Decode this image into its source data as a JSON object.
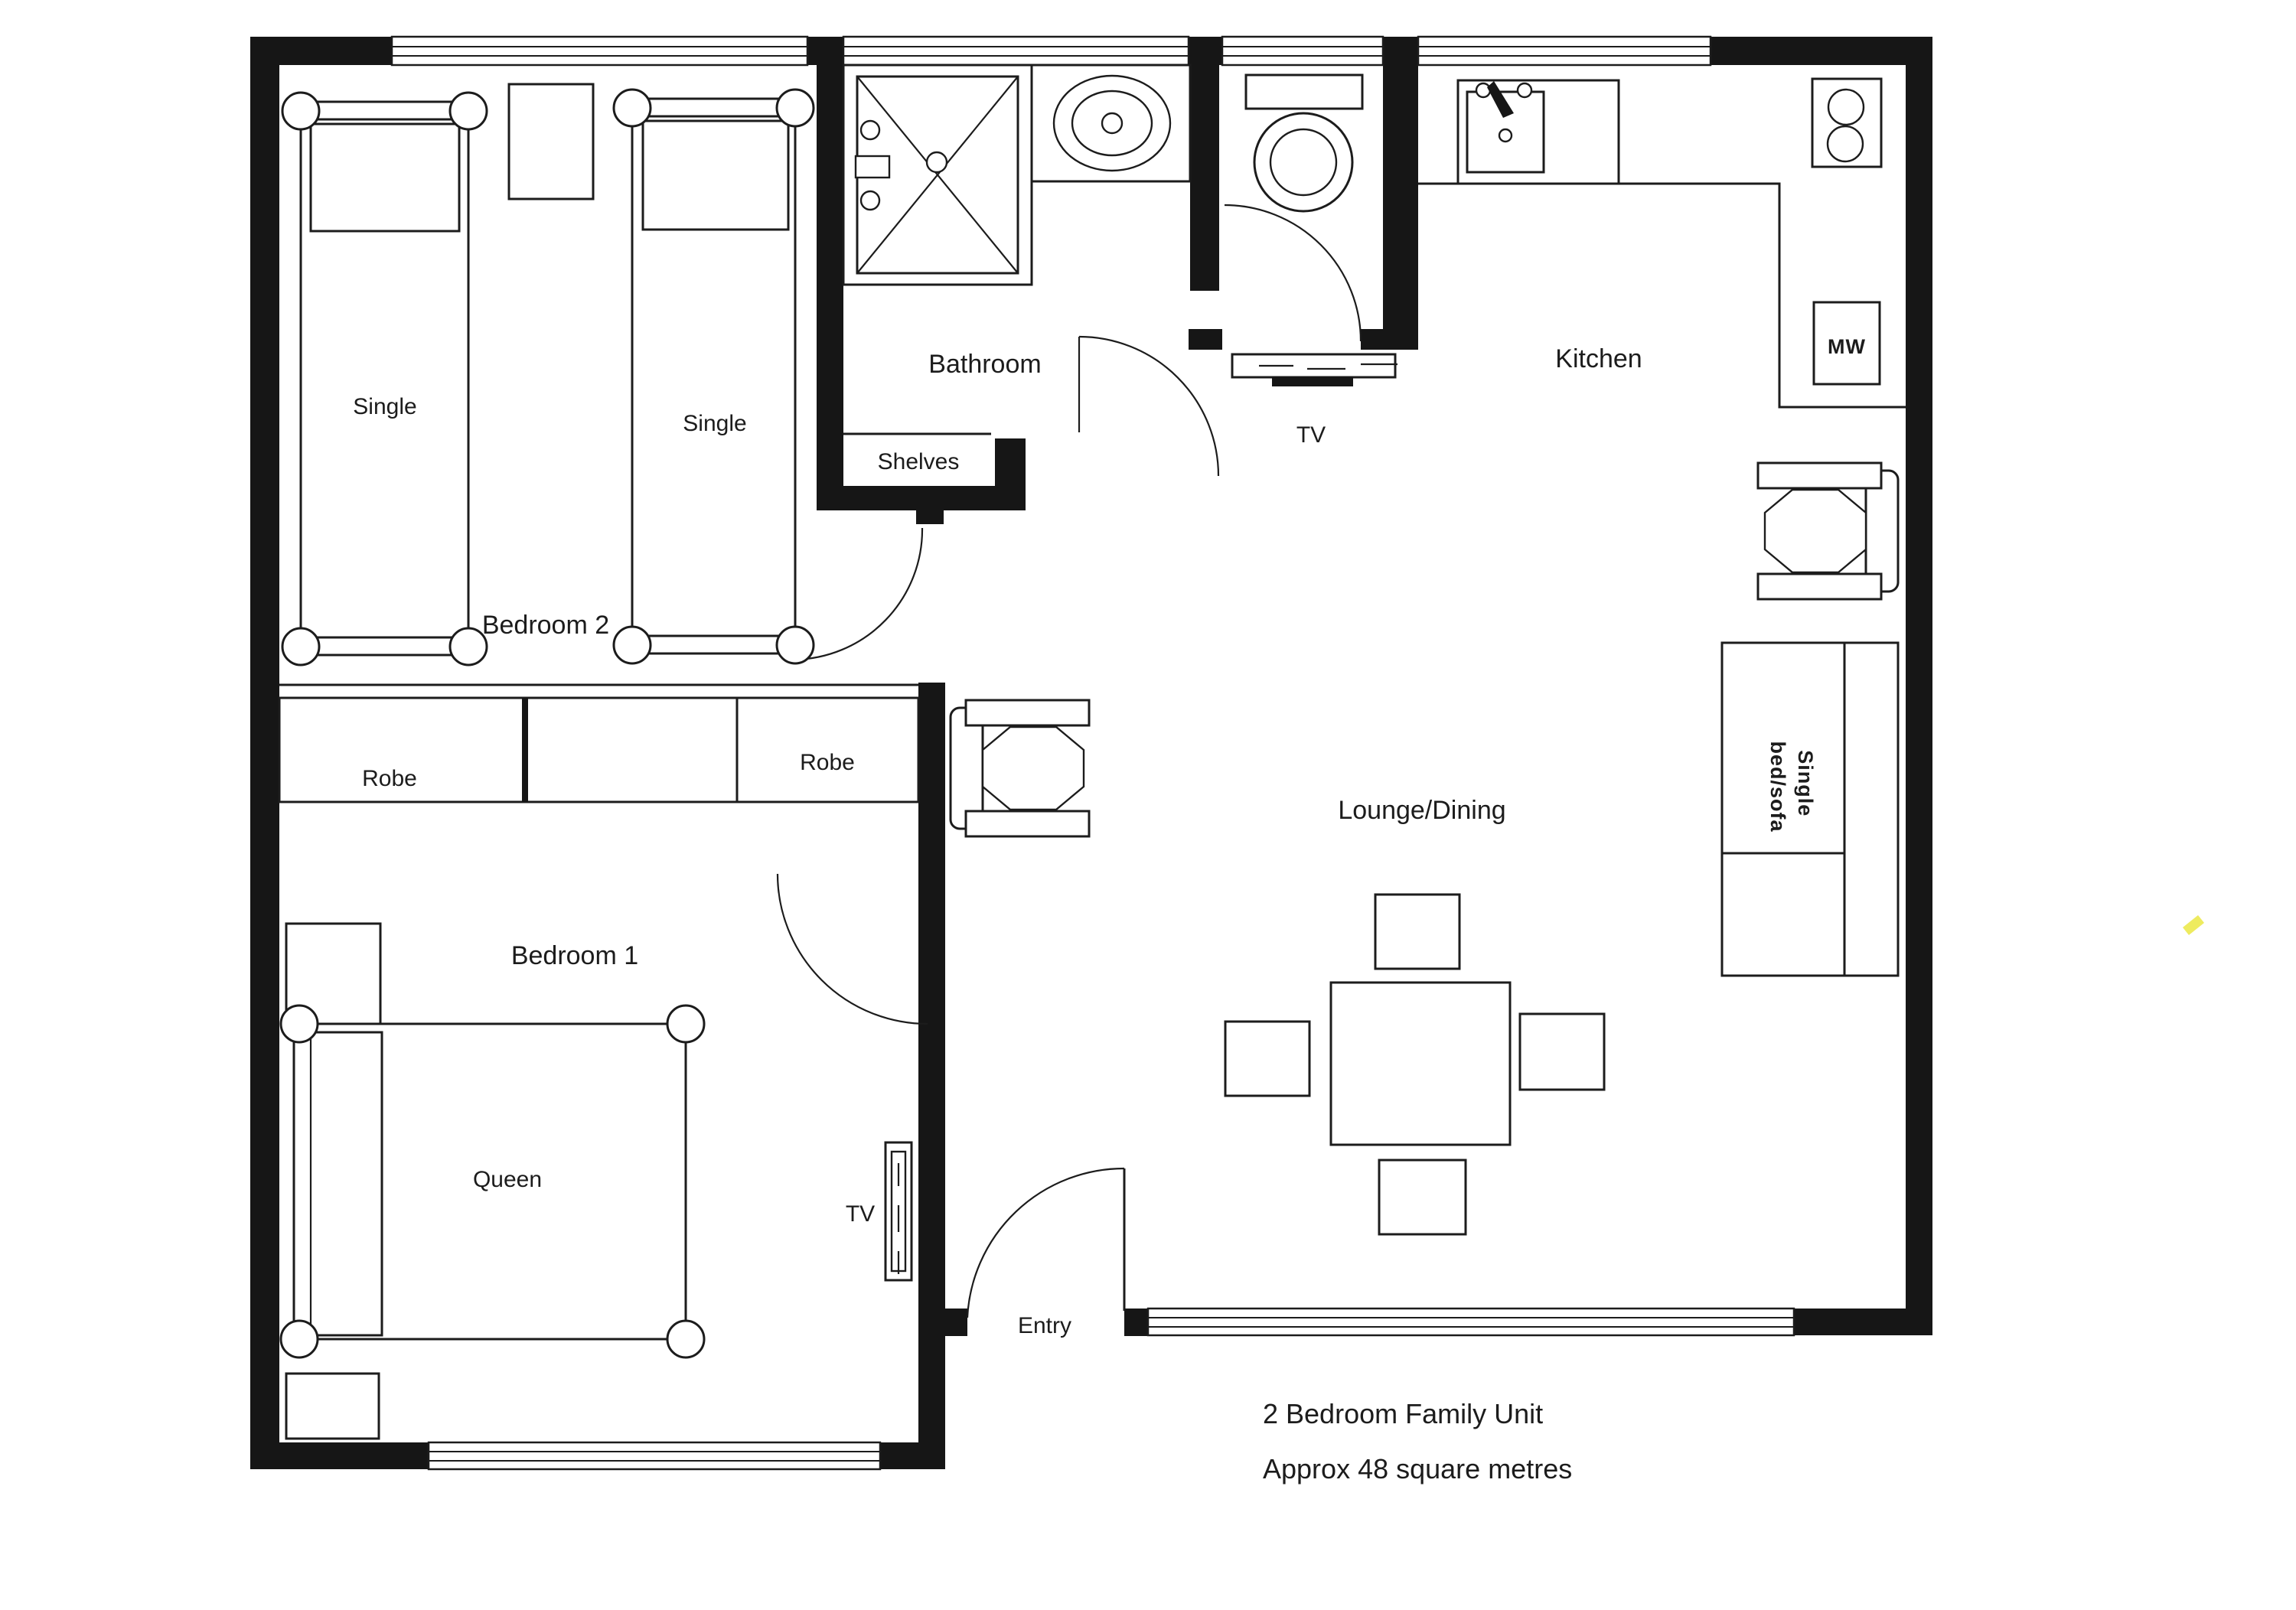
{
  "labels": {
    "bedroom2": "Bedroom 2",
    "bedroom1": "Bedroom 1",
    "bathroom": "Bathroom",
    "kitchen": "Kitchen",
    "lounge_dining": "Lounge/Dining",
    "entry": "Entry",
    "shelves": "Shelves",
    "robe_left": "Robe",
    "robe_right": "Robe",
    "single_bed_1": "Single",
    "single_bed_2": "Single",
    "queen_bed": "Queen",
    "microwave": "MW",
    "tv_wall": "TV",
    "tv_bedroom": "TV",
    "sofa_line_1": "Single",
    "sofa_line_2": "bed/sofa"
  },
  "footer": {
    "title": "2 Bedroom Family Unit",
    "subtitle": "Approx 48 square metres"
  },
  "colors": {
    "ink": "#1c1c1c",
    "paper": "#ffffff",
    "highlight": "#ece94e"
  }
}
